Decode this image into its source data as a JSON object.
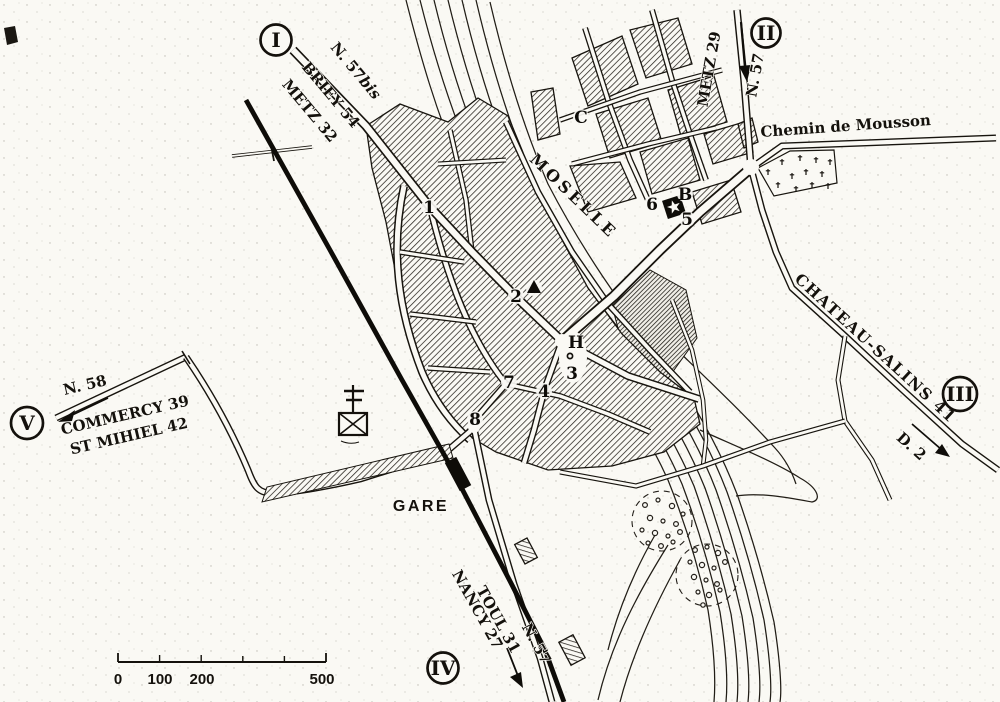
{
  "map": {
    "kind": "vintage town plan (engraved style)",
    "paper_color": "#faf9f4",
    "ink_color": "#17140e",
    "river_label": "MOSELLE",
    "station_label": "GARE"
  },
  "roads": {
    "n57bis": {
      "ref_prefix": "N. 57",
      "ref_suffix": "bis",
      "dest1": "BRIEY 54",
      "dest2": "METZ 32"
    },
    "n57_north": {
      "ref": "N. 57",
      "dest": "METZ 29"
    },
    "chemin_mousson": {
      "name": "Chemin de Mousson"
    },
    "d2": {
      "ref": "D. 2",
      "dest": "CHATEAU-SALINS 41"
    },
    "n58": {
      "ref": "N. 58",
      "dest1": "COMMERCY 39",
      "dest2": "ST MIHIEL 42"
    },
    "n57_south": {
      "ref": "N. 57",
      "dest1": "NANCY 27",
      "dest2": "TOUL 31"
    }
  },
  "junction_badges": {
    "i": "I",
    "ii": "II",
    "iii": "III",
    "iv": "IV",
    "v": "V"
  },
  "markers": {
    "m1": "1",
    "m2": "2",
    "m3": "3",
    "m4": "4",
    "m5": "5",
    "m6": "6",
    "m7": "7",
    "m8": "8",
    "b": "B",
    "c": "C",
    "h": "H"
  },
  "scale_bar": {
    "labels": [
      "0",
      "100",
      "200",
      "500"
    ]
  },
  "icons": {
    "sight_star": "star-in-black-square",
    "sight_triangle": "black-triangle",
    "town_hall_dot": "small-open-circle",
    "cross_monument": "cross-over-boxed-x",
    "cemetery": "field-of-small-crosses",
    "orchard": "dashed-circle-with-dots",
    "station_building": "solid-black-rectangle",
    "railway": "heavy-black-line"
  }
}
